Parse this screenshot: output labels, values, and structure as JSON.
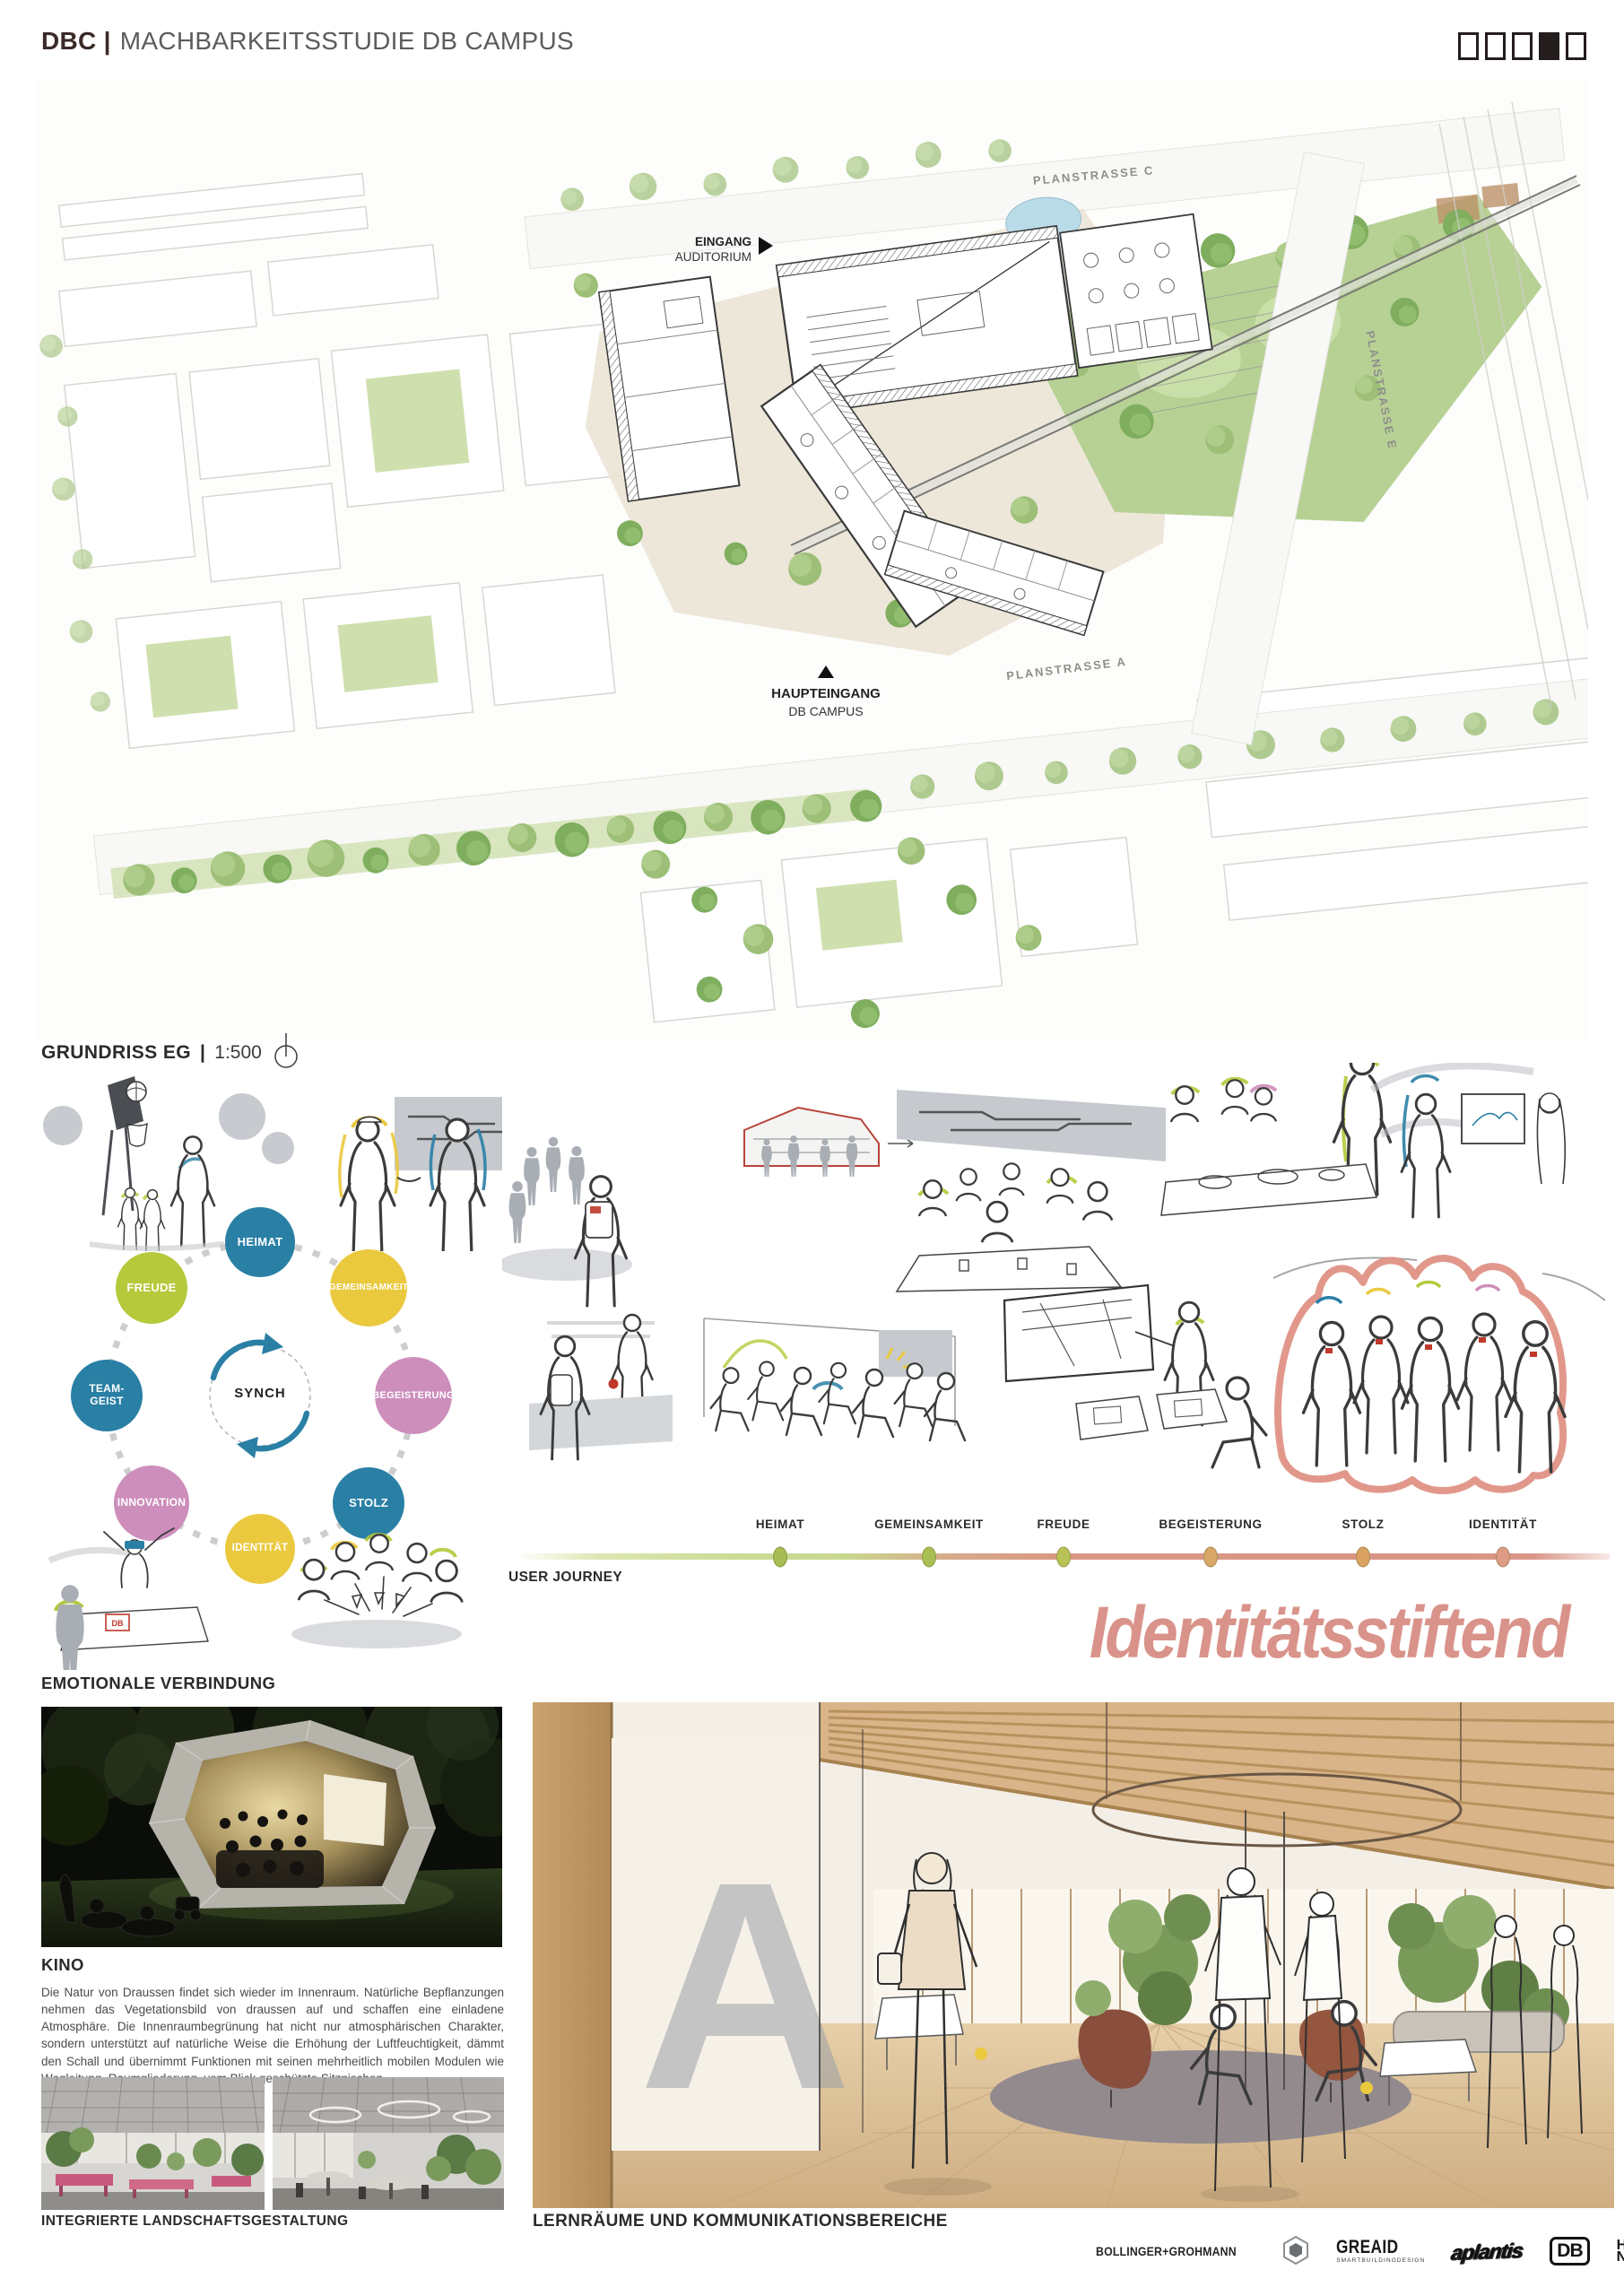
{
  "header": {
    "brand": "DBC",
    "divider": "|",
    "title": "MACHBARKEITSSTUDIE DB CAMPUS",
    "pages_total": 5,
    "active_page": 4
  },
  "site_plan": {
    "caption_title": "GRUNDRISS EG",
    "caption_divider": "|",
    "caption_scale": "1:500",
    "street_c": "PLANSTRASSE C",
    "street_e": "PLANSTRASSE E",
    "street_a": "PLANSTRASSE A",
    "entrance_auditorium_line1": "EINGANG",
    "entrance_auditorium_line2": "AUDITORIUM",
    "main_entrance_line1": "HAUPTEINGANG",
    "main_entrance_line2": "DB CAMPUS"
  },
  "synch_diagram": {
    "center_label": "SYNCH",
    "caption": "EMOTIONALE VERBINDUNG",
    "nodes": [
      {
        "label": "HEIMAT",
        "color": "#2a7fa5"
      },
      {
        "label": "GEMEINSAMKEIT",
        "color": "#eac93f"
      },
      {
        "label": "BEGEISTERUNG",
        "color": "#cd8ebc"
      },
      {
        "label": "STOLZ",
        "color": "#2a7fa5"
      },
      {
        "label": "IDENTITÄT",
        "color": "#eac93f"
      },
      {
        "label": "INNOVATION",
        "color": "#cd8ebc"
      },
      {
        "label": "TEAM-GEIST",
        "color": "#2a7fa5"
      },
      {
        "label": "FREUDE",
        "color": "#b5c93a"
      }
    ]
  },
  "sketches": {
    "db_mark": "DB"
  },
  "user_journey": {
    "label": "USER JOURNEY",
    "stations": [
      "HEIMAT",
      "GEMEINSAMKEIT",
      "FREUDE",
      "BEGEISTERUNG",
      "STOLZ",
      "IDENTITÄT"
    ],
    "dot_colors": [
      "#a7bc55",
      "#aabf53",
      "#b9c257",
      "#d8a768",
      "#d9a263",
      "#de9b86"
    ],
    "headline": "Identitätsstiftend",
    "headline_color": "#d9938a"
  },
  "kino": {
    "title": "KINO",
    "body": "Die Natur von Draussen findet sich wieder im Innenraum. Natürliche Bepflanzungen nehmen das Vegetationsbild von draussen auf und schaffen eine einladene Atmosphäre. Die Innenraumbegrünung hat nicht nur atmosphärischen Charakter, sondern unterstützt auf natürliche Weise die Erhöhung der Luftfeuchtigkeit, dämmt den Schall und übernimmt Funktionen mit seinen mehrheitlich mobilen Modulen wie Wegleitung, Raumgliederung, vom Blick geschützte Sitznischen.",
    "caption_left": "INTEGRIERTE LANDSCHAFTSGESTALTUNG",
    "caption_right": "LERNRÄUME UND KOMMUNIKATIONSBEREICHE"
  },
  "interior": {
    "signage": "A"
  },
  "footer": {
    "logo_1": "BOLLINGER+GROHMANN",
    "logo_2": "GREAID",
    "logo_2_sub": "SMARTBUILDINGDESIGN",
    "logo_3": "aplantis",
    "logo_4": "DB",
    "logo_5_line1": "HE",
    "logo_5_line2": "NN"
  },
  "colors": {
    "teal": "#2a7fa5",
    "yellow": "#eac93f",
    "pink": "#cd8ebc",
    "green": "#b5c93a",
    "salmon": "#d9938a",
    "brand_dark": "#3b2a28",
    "plan_green": "#b7d194",
    "plan_beige": "#eae3d4"
  }
}
